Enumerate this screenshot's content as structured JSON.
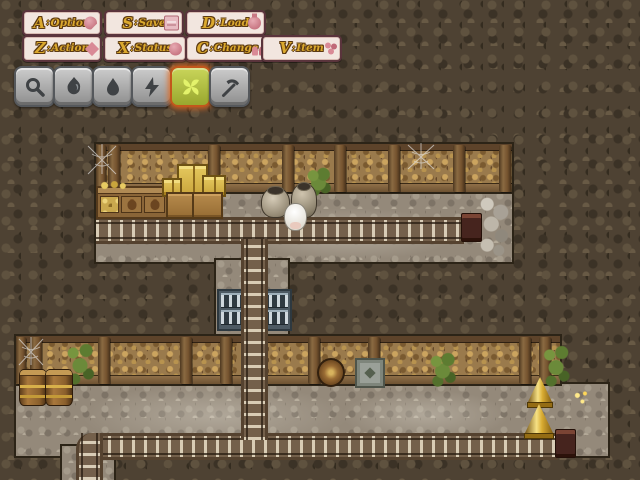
{
  "menu": {
    "sep": ":",
    "buttons": [
      {
        "key": "A",
        "label": "Option",
        "icon": "wrench"
      },
      {
        "key": "S",
        "label": "Save",
        "icon": "book"
      },
      {
        "key": "D",
        "label": "Load",
        "icon": "flask"
      },
      {
        "key": "Z",
        "label": "Action",
        "icon": "spark"
      },
      {
        "key": "X",
        "label": "Status",
        "icon": "orb"
      },
      {
        "key": "C",
        "label": "Change",
        "icon": "people"
      },
      {
        "key": "V",
        "label": "Item",
        "icon": "flower"
      }
    ]
  },
  "toolbar": {
    "tools": [
      {
        "name": "search",
        "selected": false
      },
      {
        "name": "fire",
        "selected": false
      },
      {
        "name": "water",
        "selected": false
      },
      {
        "name": "lightning",
        "selected": false
      },
      {
        "name": "wind",
        "selected": true
      },
      {
        "name": "pickaxe",
        "selected": false
      }
    ]
  },
  "map": {
    "scene": "mine-interior",
    "objects": [
      "spiderwebs",
      "goods-counter",
      "gold-ore-crates",
      "wooden-crates",
      "ceramic-pots",
      "sheep-npc",
      "mine-tracks",
      "ladder-track",
      "track-bumpers",
      "bottle-rack",
      "barrel-stack",
      "side-barrel",
      "supply-crate",
      "wall-plants",
      "hanging-vine",
      "gold-bells",
      "ore-sparkle",
      "rock-rubble"
    ]
  },
  "colors": {
    "accent_gold": "#dba92e",
    "button_bg": "#f2e6df",
    "button_border": "#5a343c",
    "selected_tool_bg": "#b3c044",
    "selected_tool_border": "#c2571c",
    "cave": "#4e4233",
    "floor": "#94897a",
    "wall": "#9a7a4c"
  }
}
